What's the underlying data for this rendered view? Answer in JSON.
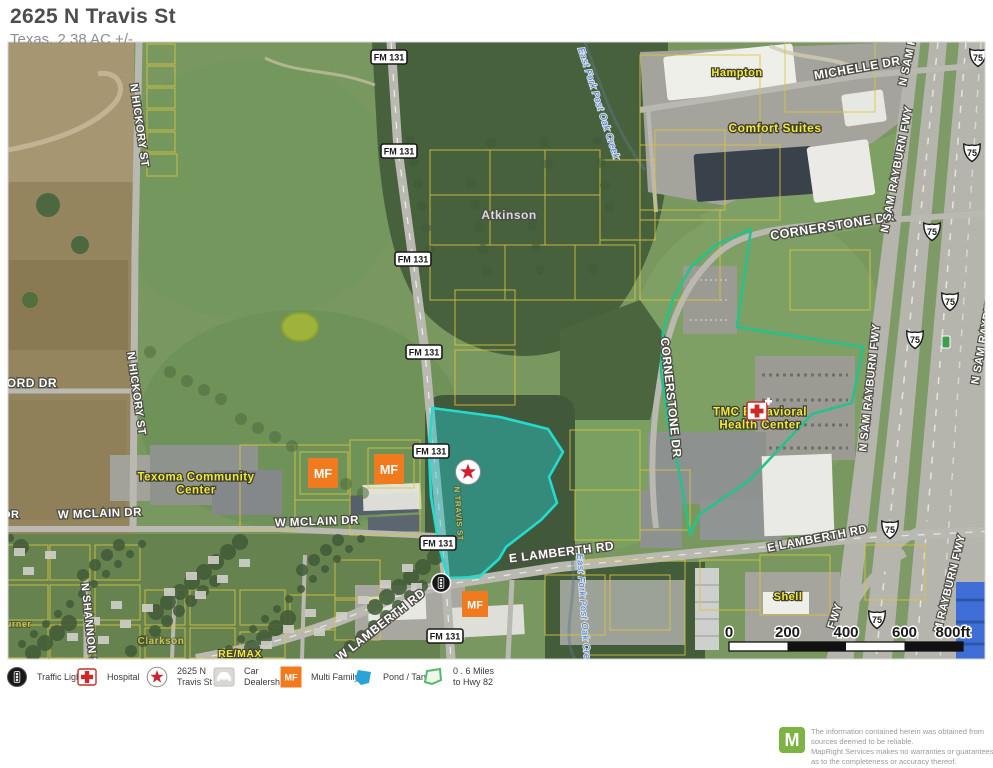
{
  "header": {
    "title": "2625 N Travis St",
    "subtitle": "Texas, 2.38 AC +/-"
  },
  "map": {
    "colors": {
      "lot_fill": "#28c8cd",
      "lot_stroke": "#22dccd",
      "radius_stroke": "#27c18b",
      "mf_orange": "#f07a1d",
      "hospital_red": "#cc2a2a",
      "star_red": "#ce2030",
      "creek_blue": "#4a78c0",
      "poi_yellow": "#f2ea3a",
      "pond_blue": "#2ba3d8",
      "mile_marker_green": "#3f9e4d"
    },
    "lot": {
      "name": "2625 N Travis St Lot",
      "points": "432,408 500,417 548,429 563,452 549,477 557,503 541,520 506,547 499,559 479,577 448,578 439,546 431,497 429,452"
    },
    "radius": {
      "name": "0 . 6 Miles to Hwy 82",
      "points": "690,534 679,470 668,424 661,372 663,331 673,299 691,267 716,245 751,229 737,327 863,347 852,403 812,414 750,480 700,514"
    },
    "road_labels": [
      {
        "t": "MICHELLE DR",
        "x": 858,
        "y": 72,
        "r": -10,
        "s": 12
      },
      {
        "t": "CORNERSTONE DR",
        "x": 833,
        "y": 230,
        "r": -9,
        "s": 12.5
      },
      {
        "t": "CORNERSTONE DR",
        "x": 667,
        "y": 398,
        "r": 84,
        "s": 12
      },
      {
        "t": "N SAM R",
        "x": 911,
        "y": 62,
        "r": -78,
        "s": 11
      },
      {
        "t": "N SAM RAYBURN FWY",
        "x": 900,
        "y": 170,
        "r": -79,
        "s": 11
      },
      {
        "t": "N SAM RAYBURN FWY",
        "x": 873,
        "y": 388,
        "r": -84,
        "s": 11
      },
      {
        "t": "N SAM RAYBURN",
        "x": 987,
        "y": 336,
        "r": -80,
        "s": 11
      },
      {
        "t": "M RAYBURN FWY",
        "x": 953,
        "y": 584,
        "r": -76,
        "s": 11
      },
      {
        "t": "FWY",
        "x": 838,
        "y": 617,
        "r": -72,
        "s": 11
      },
      {
        "t": "N HICKORY ST",
        "x": 136,
        "y": 126,
        "r": 82,
        "s": 11
      },
      {
        "t": "N HICKORY ST",
        "x": 133,
        "y": 394,
        "r": 82,
        "s": 11
      },
      {
        "t": "FORD DR",
        "x": 28,
        "y": 387,
        "r": 0,
        "s": 12
      },
      {
        "t": "DR",
        "x": 11,
        "y": 518,
        "r": 0,
        "s": 11
      },
      {
        "t": "W MCLAIN DR",
        "x": 100,
        "y": 517,
        "r": -2,
        "s": 11.5
      },
      {
        "t": "W MCLAIN DR",
        "x": 317,
        "y": 525,
        "r": -2,
        "s": 11.5
      },
      {
        "t": "W LAMBERTH RD",
        "x": 383,
        "y": 628,
        "r": -38,
        "s": 12
      },
      {
        "t": "E LAMBERTH RD",
        "x": 562,
        "y": 556,
        "r": -7,
        "s": 12
      },
      {
        "t": "E LAMBERTH RD",
        "x": 818,
        "y": 542,
        "r": -11,
        "s": 11.5
      },
      {
        "t": "N SHANNON ST",
        "x": 86,
        "y": 628,
        "r": 84,
        "s": 11
      }
    ],
    "poi_labels": [
      {
        "t": "Hampton",
        "x": 737,
        "y": 76,
        "c": "y",
        "s": 11,
        "r": 0
      },
      {
        "t": "Comfort Suites",
        "x": 775,
        "y": 132,
        "c": "y",
        "s": 12,
        "r": 0
      },
      {
        "t": "Atkinson",
        "x": 509,
        "y": 219,
        "c": "g",
        "s": 12,
        "r": 0
      },
      {
        "t": "Texoma Community\nCenter",
        "x": 196,
        "y": 487,
        "c": "y",
        "s": 11.5,
        "r": 0
      },
      {
        "t": "TMC Behavioral\nHealth Center",
        "x": 760,
        "y": 422,
        "c": "y",
        "s": 11.5,
        "r": 0
      },
      {
        "t": "Shell",
        "x": 788,
        "y": 600,
        "c": "y",
        "s": 11,
        "r": 0
      },
      {
        "t": "RE/MAX",
        "x": 240,
        "y": 657,
        "c": "y",
        "s": 10.5,
        "r": 0
      },
      {
        "t": "Clarkson",
        "x": 161,
        "y": 644,
        "c": "d",
        "s": 10,
        "r": 0
      },
      {
        "t": "Turner",
        "x": 16,
        "y": 627,
        "c": "d",
        "s": 9,
        "r": 0
      },
      {
        "t": "East Fork Post Oak Creek",
        "x": 596,
        "y": 104,
        "c": "b",
        "s": 9,
        "r": 72
      },
      {
        "t": "East Fork Post Oak Creek",
        "x": 581,
        "y": 612,
        "c": "b",
        "s": 9,
        "r": 86
      },
      {
        "t": "N TRAVIS ST",
        "x": 456,
        "y": 514,
        "c": "d",
        "s": 8,
        "r": 86
      }
    ],
    "fm_shield_label": "FM 131",
    "fm_shields": [
      [
        389,
        57
      ],
      [
        399,
        151
      ],
      [
        413,
        259
      ],
      [
        424,
        352
      ],
      [
        431,
        451
      ],
      [
        438,
        543
      ],
      [
        445,
        636
      ]
    ],
    "us_shield_label": "75",
    "us_shields": [
      [
        978,
        58
      ],
      [
        972,
        153
      ],
      [
        932,
        232
      ],
      [
        950,
        302
      ],
      [
        915,
        340
      ],
      [
        890,
        530
      ],
      [
        877,
        620
      ]
    ],
    "mile_marker": [
      946,
      342
    ],
    "mf_label": "MF",
    "mf_markers": [
      [
        323,
        473,
        30
      ],
      [
        389,
        469,
        30
      ],
      [
        475,
        604,
        26
      ]
    ],
    "star_marker": [
      468,
      472
    ],
    "traffic_marker": [
      441,
      583
    ],
    "hospital_marker": [
      757,
      411
    ],
    "scalebar": {
      "labels": [
        "0",
        "200",
        "400",
        "600",
        "800ft"
      ]
    }
  },
  "legend": {
    "items": [
      {
        "icon": "traffic-light",
        "label": "Traffic Light"
      },
      {
        "icon": "hospital",
        "label": "Hospital"
      },
      {
        "icon": "star",
        "label": "2625 N\nTravis St Lot"
      },
      {
        "icon": "car-dealership",
        "label": "Car\nDealership"
      },
      {
        "icon": "multi-family",
        "label": "Multi Family",
        "icon_text": "MF"
      },
      {
        "icon": "pond",
        "label": "Pond / Tank"
      },
      {
        "icon": "hwy-distance",
        "label": "0 . 6 Miles\nto Hwy 82"
      }
    ]
  },
  "disclaimer": {
    "logo": "M",
    "lines": [
      "The information contained herein was obtained from",
      "sources deemed to be reliable.",
      "  MapRight Services makes no warranties or guarantees",
      "as to the completeness or accuracy thereof."
    ]
  }
}
